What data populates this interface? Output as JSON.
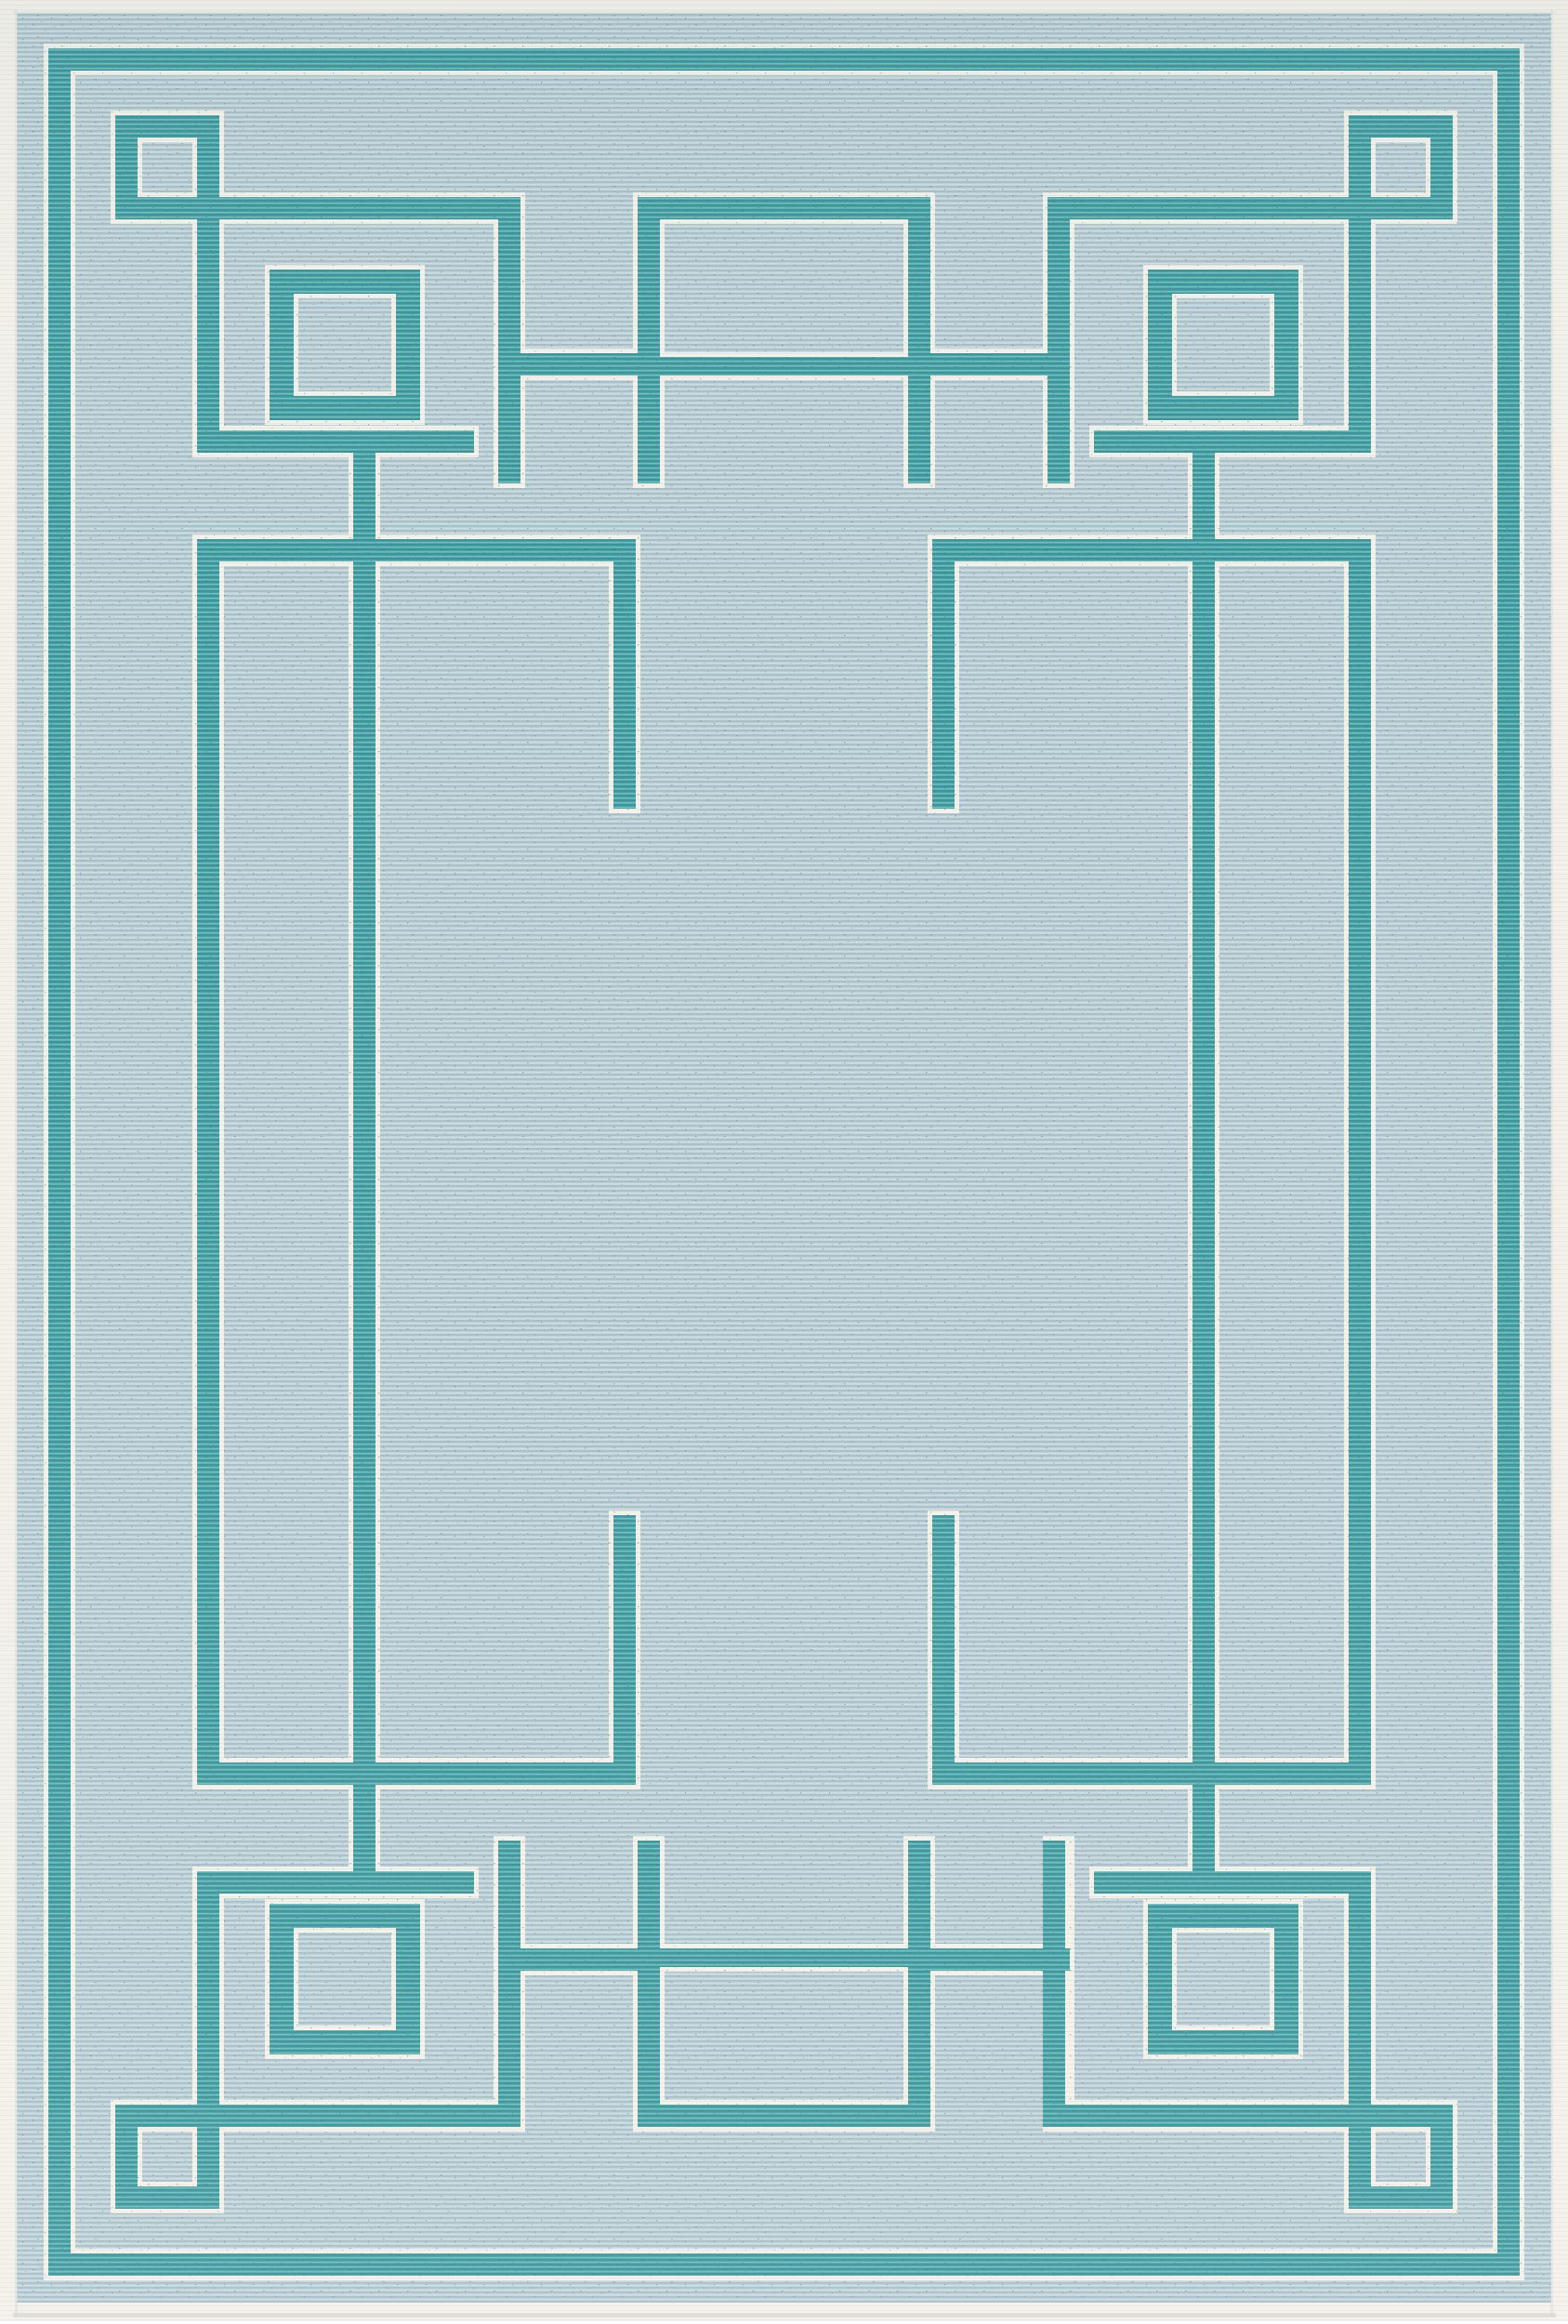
{
  "meta": {
    "content_type": "product photograph",
    "subject": "flat-weave indoor/outdoor area rug, portrait orientation",
    "caption": "Aqua blue area rug with teal Art-Deco interlocking Greek-key border, concentric corner squares, white pinstripe accents and white bound edges on a ribbed flat weave"
  },
  "colors": {
    "page_bg": "#ffffff",
    "field": "#bdd1d8",
    "field_rib_dark": "#9db6bf",
    "field_rib_light": "#cfdee2",
    "teal": "#4aa3a8",
    "teal_rib_dark": "#2f8d95",
    "teal_rib_light": "#83c4c0",
    "pinstripe": "#f3f1ea",
    "binding_rib": "#dddcd4",
    "shadow": "#d8dad6",
    "speckle": "#46656f"
  },
  "rug": {
    "style": "interlocking rectilinear Greek-fret border",
    "motifs": "two concentric-outline squares per corner, interlocking pinstriped bands, open center field",
    "texture": "horizontal ribbed weave with flecked yarn",
    "edge": "white serged binding with soft drop shadow"
  }
}
